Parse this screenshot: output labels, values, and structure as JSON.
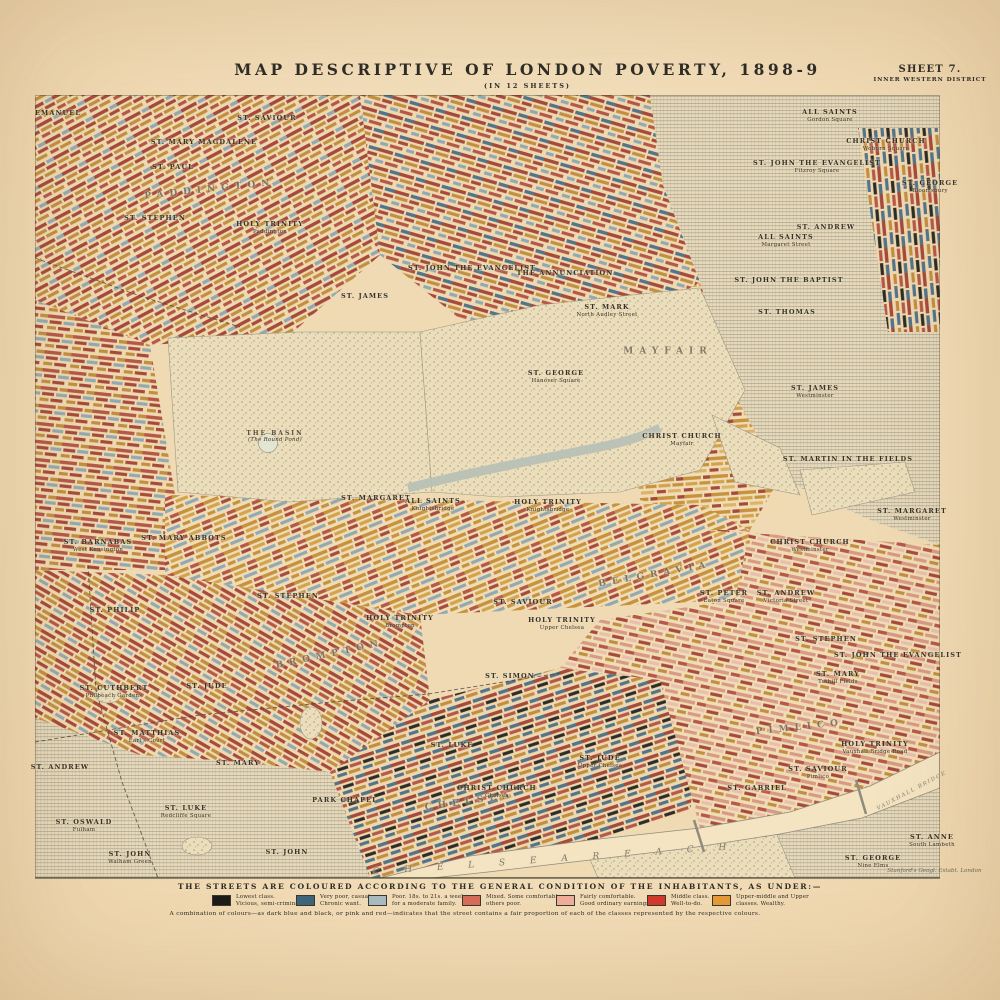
{
  "header": {
    "title": "MAP  DESCRIPTIVE  OF  LONDON  POVERTY,  1898-9",
    "subtitle": "(IN 12 SHEETS)",
    "sheet": "SHEET 7.",
    "district": "INNER WESTERN DISTRICT"
  },
  "legend": {
    "heading": "THE STREETS ARE COLOURED ACCORDING TO THE GENERAL CONDITION OF THE INHABITANTS, AS UNDER:—",
    "items": [
      {
        "color": "#1c1b18",
        "line1": "Lowest class.",
        "line2": "Vicious, semi-criminal.",
        "x": 212
      },
      {
        "color": "#3e657a",
        "line1": "Very poor, casual.",
        "line2": "Chronic want.",
        "x": 296
      },
      {
        "color": "#a9bac1",
        "line1": "Poor. 18s. to 21s. a week",
        "line2": "for a moderate family.",
        "x": 368
      },
      {
        "color": "#d56c59",
        "line1": "Mixed. Some comfortable,",
        "line2": "others poor.",
        "x": 462
      },
      {
        "color": "#f0ae9d",
        "line1": "Fairly comfortable.",
        "line2": "Good ordinary earnings.",
        "x": 556
      },
      {
        "color": "#d23a2c",
        "line1": "Middle class.",
        "line2": "Well-to-do.",
        "x": 647
      },
      {
        "color": "#e69a37",
        "line1": "Upper-middle and Upper",
        "line2": "classes.  Wealthy.",
        "x": 712
      }
    ],
    "note": "A combination of colours—as dark blue and black, or pink and red—indicates that the street contains a fair proportion of each of the classes represented by the respective colours.",
    "credit": "Stanford's Geogl. Estabt. London"
  },
  "map": {
    "labels": [
      {
        "t": "EMANUEL",
        "x": 58,
        "y": 114
      },
      {
        "t": "ST. SAVIOUR",
        "x": 267,
        "y": 119
      },
      {
        "t": "ST. MARY MAGDALENE",
        "x": 204,
        "y": 143
      },
      {
        "t": "ST. PAUL",
        "x": 173,
        "y": 168
      },
      {
        "t": "ST. STEPHEN",
        "x": 155,
        "y": 219
      },
      {
        "t": "HOLY TRINITY",
        "s": "Paddington",
        "x": 270,
        "y": 228
      },
      {
        "t": "PADDINGTON",
        "x": 210,
        "y": 190,
        "cls": "district",
        "rot": -6
      },
      {
        "t": "ALL SAINTS",
        "s": "Gordon Square",
        "x": 830,
        "y": 116
      },
      {
        "t": "CHRIST CHURCH",
        "s": "Woburn Square",
        "x": 886,
        "y": 145
      },
      {
        "t": "ST. JOHN THE EVANGELIST",
        "s": "Fitzroy Square",
        "x": 817,
        "y": 167
      },
      {
        "t": "ST. GEORGE",
        "s": "Bloomsbury",
        "x": 930,
        "y": 187
      },
      {
        "t": "ST. ANDREW",
        "x": 826,
        "y": 228
      },
      {
        "t": "ALL SAINTS",
        "s": "Margaret Street",
        "x": 786,
        "y": 241
      },
      {
        "t": "ST. JOHN THE BAPTIST",
        "x": 789,
        "y": 281
      },
      {
        "t": "ST. JAMES",
        "x": 365,
        "y": 297
      },
      {
        "t": "ST. JOHN THE EVANGELIST",
        "x": 472,
        "y": 269
      },
      {
        "t": "THE ANNUNCIATION",
        "x": 565,
        "y": 274
      },
      {
        "t": "ST. MARK",
        "s": "North Audley Street",
        "x": 607,
        "y": 311
      },
      {
        "t": "ST. THOMAS",
        "x": 787,
        "y": 313
      },
      {
        "t": "MAYFAIR",
        "x": 668,
        "y": 352,
        "cls": "district"
      },
      {
        "t": "ST. GEORGE",
        "s": "Hanover Square",
        "x": 556,
        "y": 377
      },
      {
        "t": "THE BASIN",
        "s": "(The Round Pond)",
        "x": 275,
        "y": 437,
        "cls": "basin"
      },
      {
        "t": "CHRIST CHURCH",
        "s": "Mayfair",
        "x": 682,
        "y": 440
      },
      {
        "t": "ST. JAMES",
        "s": "Westminster",
        "x": 815,
        "y": 392
      },
      {
        "t": "ST. MARTIN IN THE FIELDS",
        "x": 848,
        "y": 460
      },
      {
        "t": "ST. MARGARET",
        "x": 376,
        "y": 499
      },
      {
        "t": "ALL SAINTS",
        "s": "Knightsbridge",
        "x": 433,
        "y": 505
      },
      {
        "t": "HOLY TRINITY",
        "s": "Knightsbridge",
        "x": 548,
        "y": 506
      },
      {
        "t": "ST. MARGARET",
        "s": "Westminster",
        "x": 912,
        "y": 515
      },
      {
        "t": "CHRIST CHURCH",
        "s": "Westminster",
        "x": 810,
        "y": 546
      },
      {
        "t": "ST. BARNABAS",
        "s": "West Kensington",
        "x": 98,
        "y": 546
      },
      {
        "t": "ST. MARY ABBOTS",
        "x": 184,
        "y": 539
      },
      {
        "t": "ST. PETER",
        "s": "Eaton Square",
        "x": 724,
        "y": 597
      },
      {
        "t": "ST. ANDREW",
        "s": "Victoria Street",
        "x": 786,
        "y": 597
      },
      {
        "t": "HOLY TRINITY",
        "s": "Brompton",
        "x": 400,
        "y": 622
      },
      {
        "t": "ST. SAVIOUR",
        "x": 523,
        "y": 603
      },
      {
        "t": "HOLY TRINITY",
        "s": "Upper Chelsea",
        "x": 562,
        "y": 624
      },
      {
        "t": "ST. PHILIP",
        "x": 115,
        "y": 611
      },
      {
        "t": "ST. STEPHEN",
        "x": 288,
        "y": 597
      },
      {
        "t": "ST. STEPHEN",
        "x": 826,
        "y": 640
      },
      {
        "t": "ST. JOHN THE EVANGELIST",
        "x": 898,
        "y": 656
      },
      {
        "t": "ST. MARY",
        "s": "Tothill Fields",
        "x": 838,
        "y": 678
      },
      {
        "t": "BELGRAVIA",
        "x": 655,
        "y": 575,
        "cls": "district",
        "rot": -10
      },
      {
        "t": "BROMPTON",
        "x": 330,
        "y": 655,
        "cls": "district",
        "rot": -12
      },
      {
        "t": "ST. SIMON",
        "x": 510,
        "y": 677
      },
      {
        "t": "ST. CUTHBERT",
        "s": "Philbeach Gardens",
        "x": 114,
        "y": 692
      },
      {
        "t": "ST. JUDE",
        "x": 207,
        "y": 687
      },
      {
        "t": "ST. MATTHIAS",
        "s": "Earl's Court",
        "x": 147,
        "y": 737
      },
      {
        "t": "ST. MARY",
        "x": 238,
        "y": 764
      },
      {
        "t": "ST. LUKE",
        "s": "Redcliffe Square",
        "x": 186,
        "y": 812
      },
      {
        "t": "ST. ANDREW",
        "x": 60,
        "y": 768
      },
      {
        "t": "ST. OSWALD",
        "s": "Fulham",
        "x": 84,
        "y": 826
      },
      {
        "t": "ST. JOHN",
        "s": "Walham Green",
        "x": 130,
        "y": 858
      },
      {
        "t": "ST. JOHN",
        "x": 287,
        "y": 853
      },
      {
        "t": "ST. LUKE",
        "x": 452,
        "y": 746
      },
      {
        "t": "CHELSEA",
        "x": 470,
        "y": 802,
        "cls": "district",
        "rot": -8
      },
      {
        "t": "PARK CHAPEL",
        "x": 345,
        "y": 801
      },
      {
        "t": "CHRIST CHURCH",
        "s": "Chelsea",
        "x": 497,
        "y": 792
      },
      {
        "t": "ST. JUDE",
        "s": "Upper Chelsea",
        "x": 600,
        "y": 762
      },
      {
        "t": "ST. GABRIEL",
        "x": 757,
        "y": 789
      },
      {
        "t": "PIMLICO",
        "x": 800,
        "y": 728,
        "cls": "district",
        "rot": -6
      },
      {
        "t": "HOLY TRINITY",
        "s": "Vauxhall Bridge Road",
        "x": 875,
        "y": 748
      },
      {
        "t": "ST. SAVIOUR",
        "s": "Pimlico",
        "x": 818,
        "y": 773
      },
      {
        "t": "ST. ANNE",
        "s": "South Lambeth",
        "x": 932,
        "y": 841
      },
      {
        "t": "ST. GEORGE",
        "s": "Nine Elms",
        "x": 873,
        "y": 862
      },
      {
        "t": "C H E L S E A     R E A C H",
        "x": 555,
        "y": 860,
        "cls": "river",
        "rot": -4
      },
      {
        "t": "VAUXHALL BRIDGE",
        "x": 912,
        "y": 791,
        "cls": "river2",
        "rot": -28
      }
    ]
  }
}
